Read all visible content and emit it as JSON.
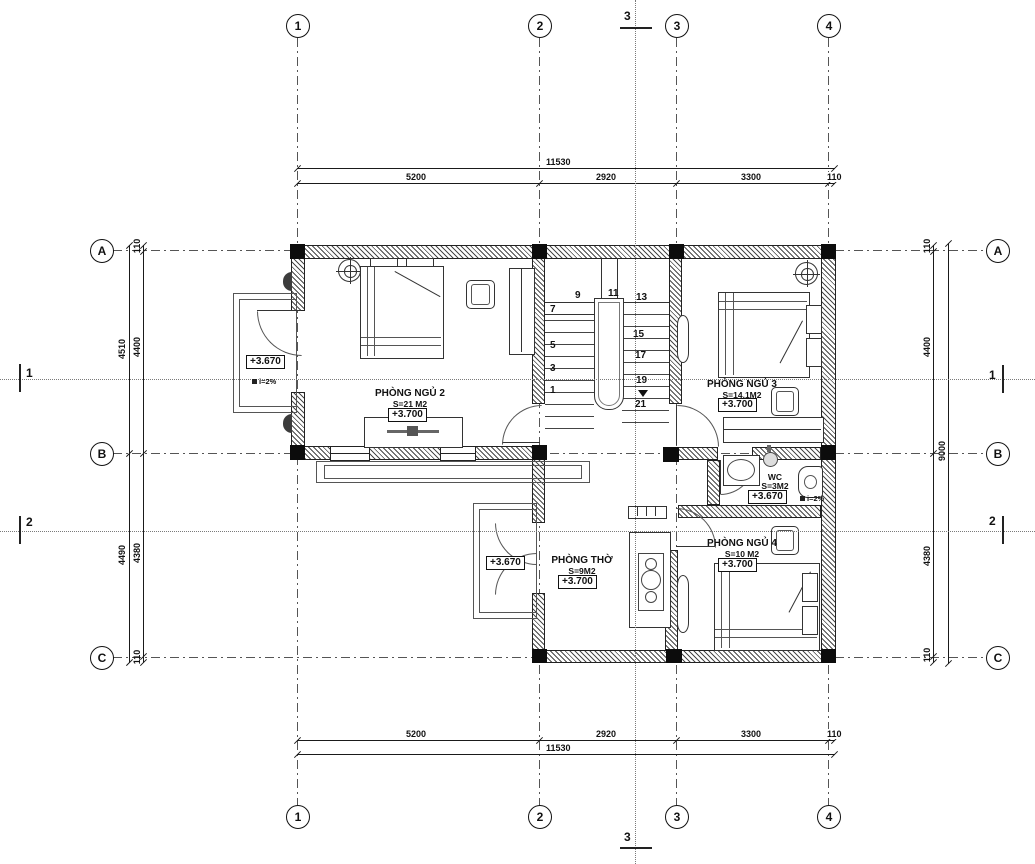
{
  "drawing": {
    "title": "floor-plan-level-2",
    "grid": {
      "cols": [
        "1",
        "2",
        "3",
        "4"
      ],
      "rows": [
        "A",
        "B",
        "C"
      ]
    },
    "sections": {
      "s1": "1",
      "s2": "2",
      "s3": "3"
    },
    "dims": {
      "top": {
        "total": "11530",
        "segs": [
          "5200",
          "2920",
          "3300",
          "110"
        ]
      },
      "bottom": {
        "total": "11530",
        "segs": [
          "5200",
          "2920",
          "3300",
          "110"
        ]
      },
      "left": {
        "outer": [
          "4510",
          "4490"
        ],
        "inner": [
          "110",
          "4400",
          "4380",
          "110"
        ]
      },
      "right": {
        "total": "9000",
        "inner": [
          "110",
          "4400",
          "4380",
          "110"
        ]
      }
    },
    "rooms": {
      "bedroom2": {
        "name": "PHÒNG NGỦ 2",
        "area": "S=21 M2",
        "level": "+3.700"
      },
      "bedroom3": {
        "name": "PHÒNG NGỦ 3",
        "area": "S=14.1M2",
        "level": "+3.700"
      },
      "bedroom4": {
        "name": "PHÒNG NGỦ 4",
        "area": "S=10 M2",
        "level": "+3.700"
      },
      "worship": {
        "name": "PHÒNG THỜ",
        "area": "S=9M2",
        "level": "+3.700"
      },
      "wc": {
        "name": "WC",
        "area": "S=3M2",
        "level": "+3.670",
        "slope": "i=2%"
      }
    },
    "balconies": {
      "left": {
        "level": "+3.670",
        "slope": "i=2%"
      },
      "worship": {
        "level": "+3.670"
      }
    },
    "stair": {
      "numbers": [
        "1",
        "3",
        "5",
        "7",
        "9",
        "11",
        "13",
        "15",
        "17",
        "19",
        "21"
      ]
    }
  }
}
